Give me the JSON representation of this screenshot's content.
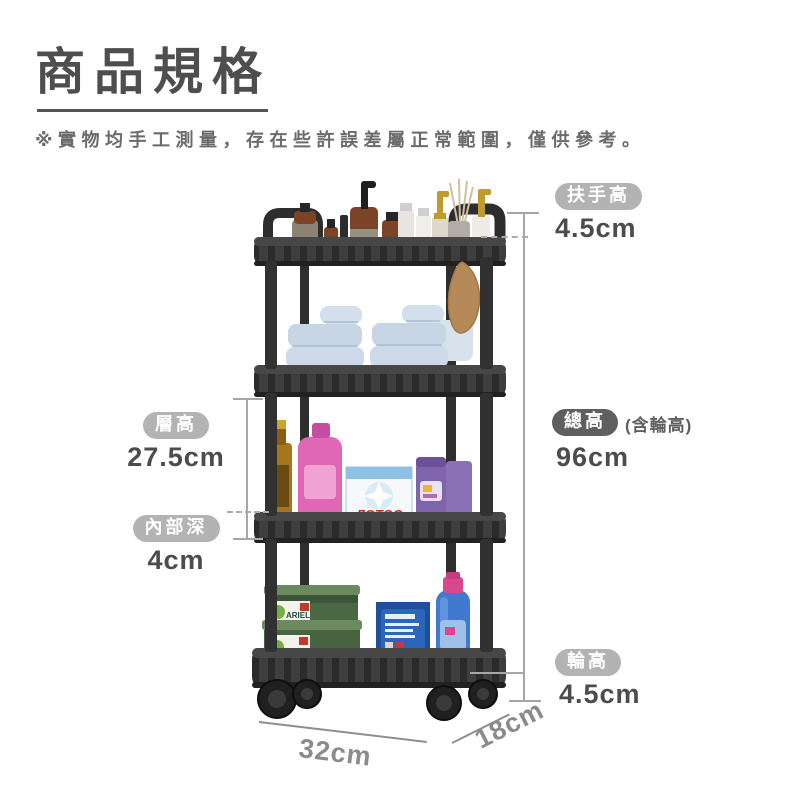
{
  "header": {
    "title": "商品規格",
    "disclaimer": "※實物均手工測量，存在些許誤差屬正常範圍，僅供參考。"
  },
  "annotations": {
    "handle_height": {
      "label": "扶手高",
      "value": "4.5cm"
    },
    "total_height": {
      "label": "總高",
      "suffix": "(含輪高)",
      "value": "96cm"
    },
    "wheel_height": {
      "label": "輪高",
      "value": "4.5cm"
    },
    "tier_height": {
      "label": "層高",
      "value": "27.5cm"
    },
    "inner_depth": {
      "label": "內部深",
      "value": "4cm"
    },
    "bottom_width": {
      "value": "32cm"
    },
    "bottom_depth": {
      "value": "18cm"
    }
  },
  "product": {
    "description": "4-tier black rolling storage cart with wheels",
    "box_text_lotos": "ЛОТОС",
    "box_text_ariel": "ARIEL"
  },
  "colors": {
    "pill_light": "#b3b3b3",
    "pill_dark": "#5f5f5f",
    "value_text": "#4c4c4c",
    "measure_line": "#a6a6a6",
    "diag_text": "#8b8b8b",
    "cart_body": "#2f2f2f"
  }
}
